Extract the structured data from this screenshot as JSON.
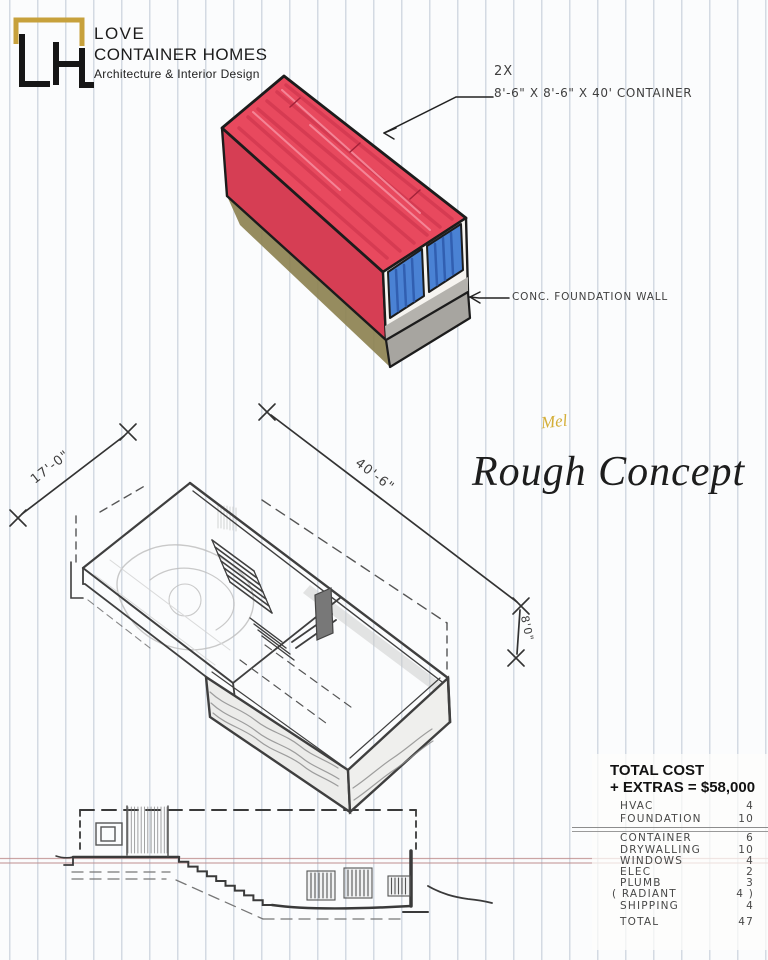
{
  "logo": {
    "monogram": "LH",
    "line1": "LOVE",
    "line2": "CONTAINER HOMES",
    "line3": "Architecture & Interior Design"
  },
  "annotations": {
    "container_qty": "2X",
    "container_dims": "8'-6\" X 8'-6\" X 40'  CONTAINER",
    "foundation_note": "CONC. FOUNDATION WALL",
    "dim_width": "17'-0\"",
    "dim_length": "40'-6\"",
    "dim_height": "8'0\"",
    "signature": "Mel",
    "sheet_title": "Rough Concept"
  },
  "cost_table": {
    "heading_line1": "TOTAL COST",
    "heading_line2": "+ EXTRAS = $58,000",
    "rows": [
      {
        "item": "HVAC",
        "value": "4"
      },
      {
        "item": "FOUNDATION",
        "value": "10"
      },
      {
        "item": "CONTAINER",
        "value": "6"
      },
      {
        "item": "DRYWALLING",
        "value": "10"
      },
      {
        "item": "WINDOWS",
        "value": "4"
      },
      {
        "item": "ELEC",
        "value": "2"
      },
      {
        "item": "PLUMB",
        "value": "3"
      },
      {
        "item": "( RADIANT",
        "value": "4 )"
      },
      {
        "item": "SHIPPING",
        "value": "4"
      },
      {
        "item": "TOTAL",
        "value": "47"
      }
    ]
  },
  "colors": {
    "container_red": "#e8495e",
    "container_red_dark": "#c93049",
    "window_blue": "#4a82d4",
    "foundation_gray": "#a7a5a0",
    "ground_khaki": "#8b7f4e",
    "logo_gold": "#c7a13c",
    "margin_line": "#c08f8f",
    "paper_line": "#a8b6c6"
  }
}
